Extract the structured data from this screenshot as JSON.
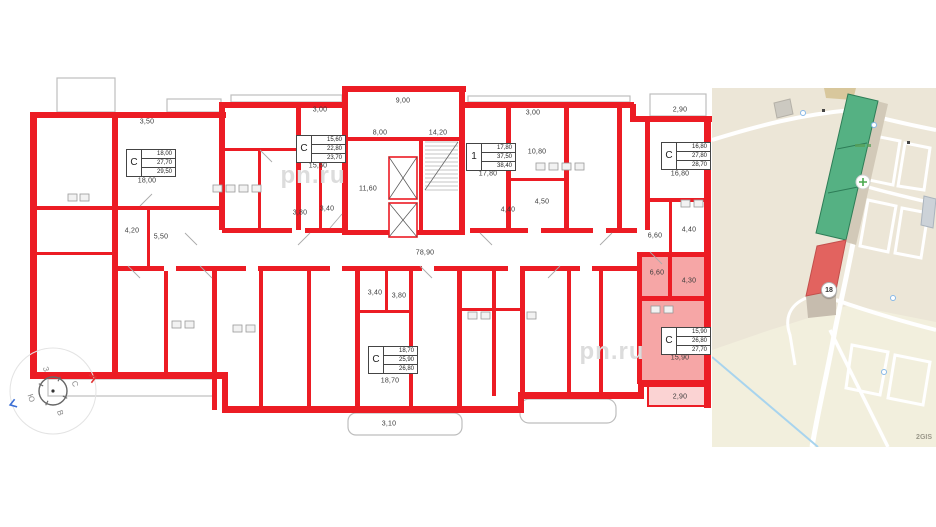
{
  "plan": {
    "units": [
      {
        "t": "С",
        "a1": "18,00",
        "a2": "27,70",
        "a3": "29,50"
      },
      {
        "t": "С",
        "a1": "15,60",
        "a2": "22,80",
        "a3": "23,70"
      },
      {
        "t": "1",
        "a1": "17,80",
        "a2": "37,50",
        "a3": "38,40"
      },
      {
        "t": "С",
        "a1": "16,80",
        "a2": "27,80",
        "a3": "28,70"
      },
      {
        "t": "С",
        "a1": "15,90",
        "a2": "26,80",
        "a3": "27,70"
      },
      {
        "t": "С",
        "a1": "18,70",
        "a2": "25,90",
        "a3": "26,80"
      }
    ],
    "labels": [
      "3,50",
      "18,00",
      "4,20",
      "5,50",
      "3,00",
      "15,60",
      "8,00",
      "9,00",
      "14,20",
      "11,60",
      "3,80",
      "3,40",
      "17,80",
      "3,00",
      "10,80",
      "4,50",
      "4,40",
      "78,90",
      "6,60",
      "4,40",
      "2,90",
      "16,80",
      "6,60",
      "4,30",
      "15,90",
      "2,90",
      "3,40",
      "3,80",
      "18,70",
      "3,10"
    ],
    "colors": {
      "wall": "#ec1c24",
      "selected_fill": "#f6a6a6",
      "selected_balcony": "#fbd3d3"
    }
  },
  "watermark": "pn.ru",
  "compass": {
    "north": "С",
    "east": "В",
    "south": "Ю",
    "west": "З"
  },
  "map": {
    "selected_marker": "18",
    "attribution": "2GIS",
    "colors": {
      "building_green": "#55b183",
      "building_selected": "#e2635f",
      "ground": "#ece6d7"
    }
  }
}
